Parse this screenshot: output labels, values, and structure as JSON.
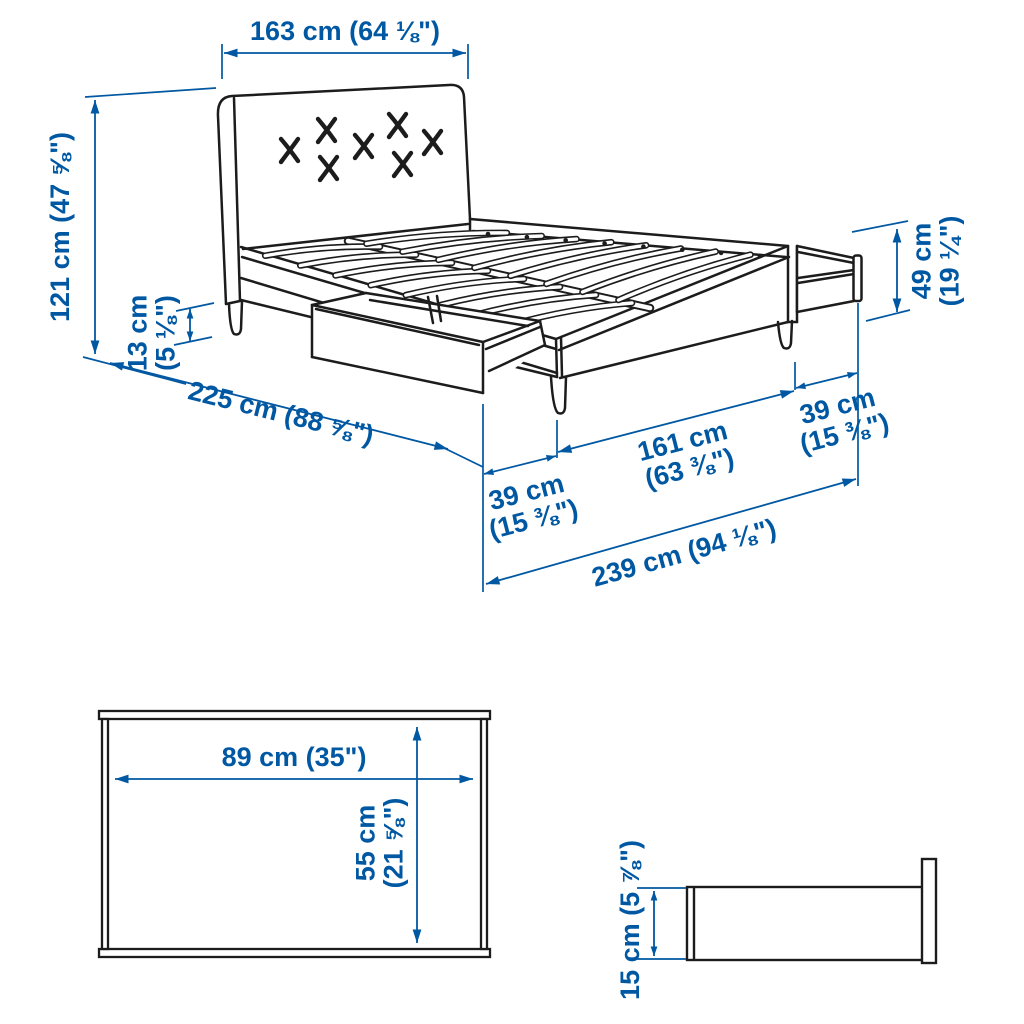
{
  "colors": {
    "dimension_blue": "#0058a3",
    "line_black": "#1c1c1c",
    "background": "#ffffff"
  },
  "bed_diagram": {
    "headboard_width_label": "163 cm (64 ⅛\")",
    "height_label": "121 cm (47 ⅝\")",
    "clearance_line1": "13 cm",
    "clearance_line2": "(5 ⅛\")",
    "length_label": "225 cm (88 ⅝\")",
    "drawer_height_line1": "49 cm",
    "drawer_height_line2": "(19 ¼\")",
    "side_drawer_ext_line1": "39 cm",
    "side_drawer_ext_line2": "(15 ⅜\")",
    "middle_span_line1": "161 cm",
    "middle_span_line2": "(63 ⅜\")",
    "foot_drawer_ext_line1": "39 cm",
    "foot_drawer_ext_line2": "(15 ⅜\")",
    "total_length_label": "239 cm (94 ⅛\")"
  },
  "drawer_top_view": {
    "width_label": "89 cm (35\")",
    "depth_line1": "55 cm",
    "depth_line2": "(21 ⅝\")"
  },
  "drawer_side_view": {
    "height_label": "15 cm (5 ⅞\")"
  }
}
